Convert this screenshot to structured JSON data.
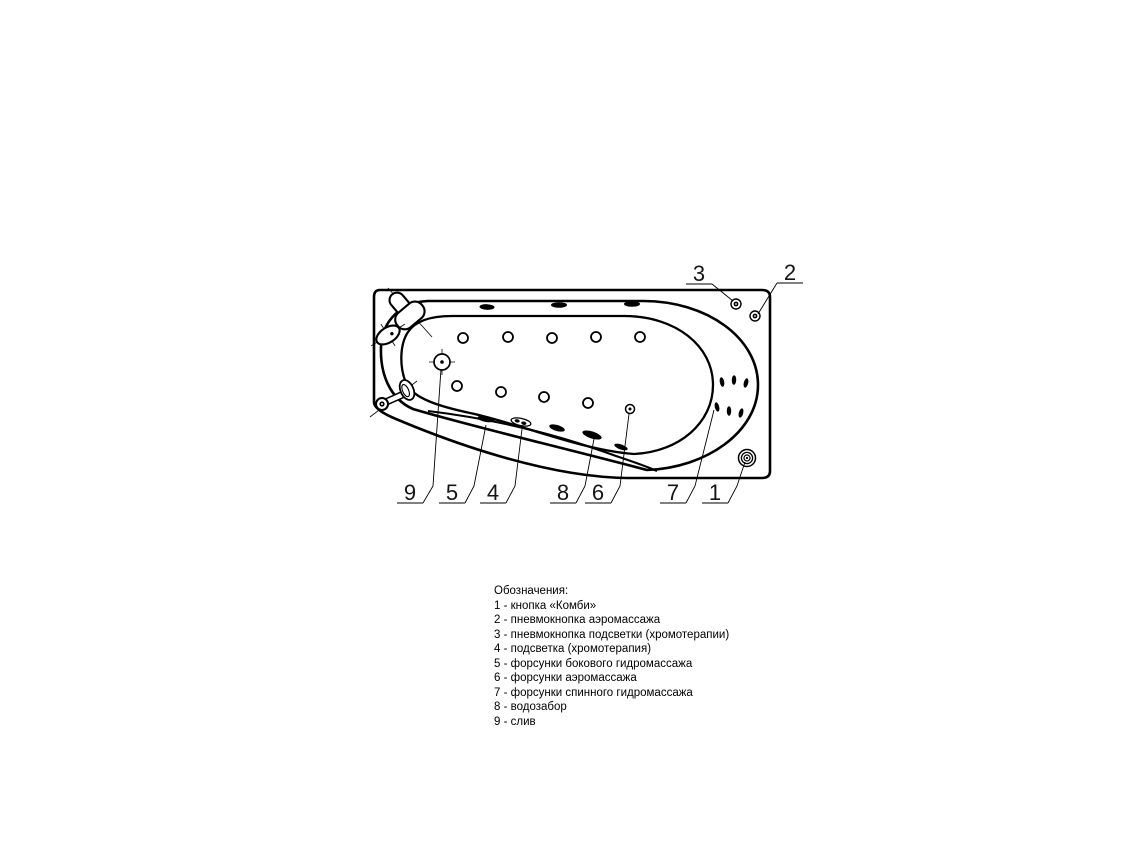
{
  "drawing": {
    "type": "bathtub-top-view-technical-diagram",
    "ink_color": "#000000",
    "background_color": "#ffffff",
    "callouts": {
      "n1": "1",
      "n2": "2",
      "n3": "3",
      "n4": "4",
      "n5": "5",
      "n6": "6",
      "n7": "7",
      "n8": "8",
      "n9": "9"
    }
  },
  "legend": {
    "title": "Обозначения:",
    "items": [
      "1 - кнопка «Комби»",
      "2 - пневмокнопка аэромассажа",
      "3 - пневмокнопка подсветки (хромотерапии)",
      "4 - подсветка (хромотерапия)",
      "5 - форсунки бокового гидромассажа",
      "6 - форсунки аэромассажа",
      "7 - форсунки спинного гидромассажа",
      "8 - водозабор",
      "9 - слив"
    ]
  }
}
